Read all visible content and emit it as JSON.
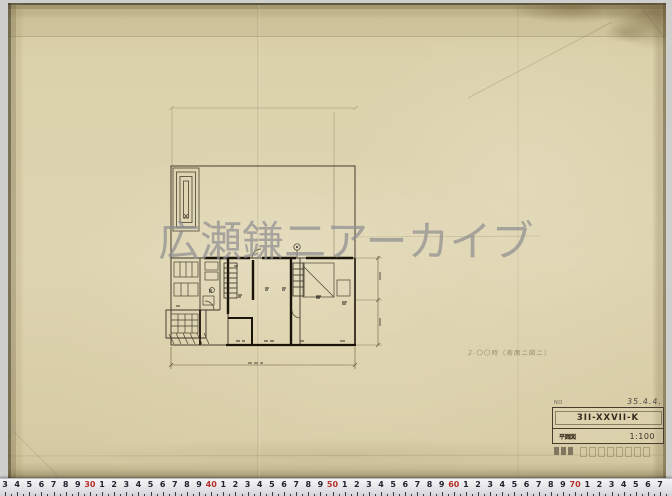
{
  "watermark": {
    "text": "広瀬鎌二アーカイブ"
  },
  "pencil_note": {
    "text": "2-〇〇時（南面ニ図ニ）"
  },
  "title_block": {
    "no_label": "NO",
    "date": "35.4.4.",
    "drawing_number": "3II-XXVII-K",
    "stamp": "平面図",
    "scale": "1:100"
  },
  "ruler": {
    "labels": [
      "3",
      "4",
      "5",
      "6",
      "7",
      "8",
      "9",
      "30",
      "1",
      "2",
      "3",
      "4",
      "5",
      "6",
      "7",
      "8",
      "9",
      "40",
      "1",
      "2",
      "3",
      "4",
      "5",
      "6",
      "7",
      "8",
      "9",
      "50",
      "1",
      "2",
      "3",
      "4",
      "5",
      "6",
      "7",
      "8",
      "9",
      "60",
      "1",
      "2",
      "3",
      "4",
      "5",
      "6",
      "7",
      "8",
      "9",
      "70",
      "1",
      "2",
      "3",
      "4",
      "5",
      "6",
      "7"
    ],
    "red_indices": [
      7,
      17,
      27,
      37,
      47
    ],
    "start_x": 5,
    "spacing": 12.13
  },
  "colors": {
    "paper": "#d9cfa9",
    "ink_thin": "#3c342a",
    "ink_thick": "#191309",
    "watermark_gray": "#8f8f91",
    "ruler_red": "#b5302a"
  }
}
